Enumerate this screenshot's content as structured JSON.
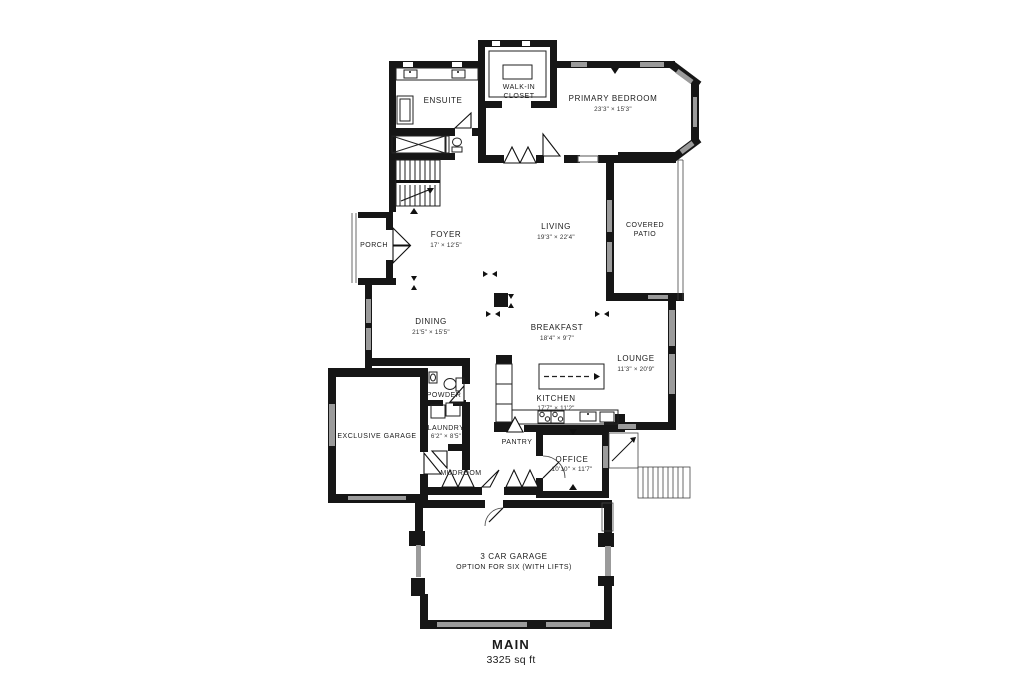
{
  "plan": {
    "colors": {
      "wall": "#161616",
      "window": "#9b9b9b",
      "background": "#ffffff",
      "text": "#1b1b1b"
    },
    "rooms": {
      "ensuite": {
        "name": "ENSUITE"
      },
      "walk_in_closet": {
        "line1": "WALK-IN",
        "line2": "CLOSET"
      },
      "primary_bedroom": {
        "name": "PRIMARY BEDROOM",
        "dims": "23'3\" × 15'3\""
      },
      "foyer": {
        "name": "FOYER",
        "dims": "17' × 12'5\""
      },
      "living": {
        "name": "LIVING",
        "dims": "19'3\" × 22'4\""
      },
      "porch": {
        "name": "PORCH"
      },
      "covered_patio": {
        "line1": "COVERED",
        "line2": "PATIO"
      },
      "dining": {
        "name": "DINING",
        "dims": "21'5\" × 15'5\""
      },
      "breakfast": {
        "name": "BREAKFAST",
        "dims": "18'4\" × 9'7\""
      },
      "lounge": {
        "name": "LOUNGE",
        "dims": "11'3\" × 20'9\""
      },
      "kitchen": {
        "name": "KITCHEN",
        "dims": "17'7\" × 11'2\""
      },
      "powder": {
        "name": "POWDER"
      },
      "laundry": {
        "name": "LAUNDRY",
        "dims": "6'2\" × 8'5\""
      },
      "mudroom": {
        "name": "MUDROOM"
      },
      "pantry": {
        "name": "PANTRY"
      },
      "exclusive_garage": {
        "name": "EXCLUSIVE GARAGE"
      },
      "office": {
        "name": "OFFICE",
        "dims": "10'10\" × 11'7\""
      },
      "three_car_garage": {
        "line1": "3 CAR GARAGE",
        "line2": "OPTION FOR SIX (WITH LIFTS)"
      }
    },
    "footer": {
      "level": "MAIN",
      "area": "3325 sq ft"
    }
  }
}
